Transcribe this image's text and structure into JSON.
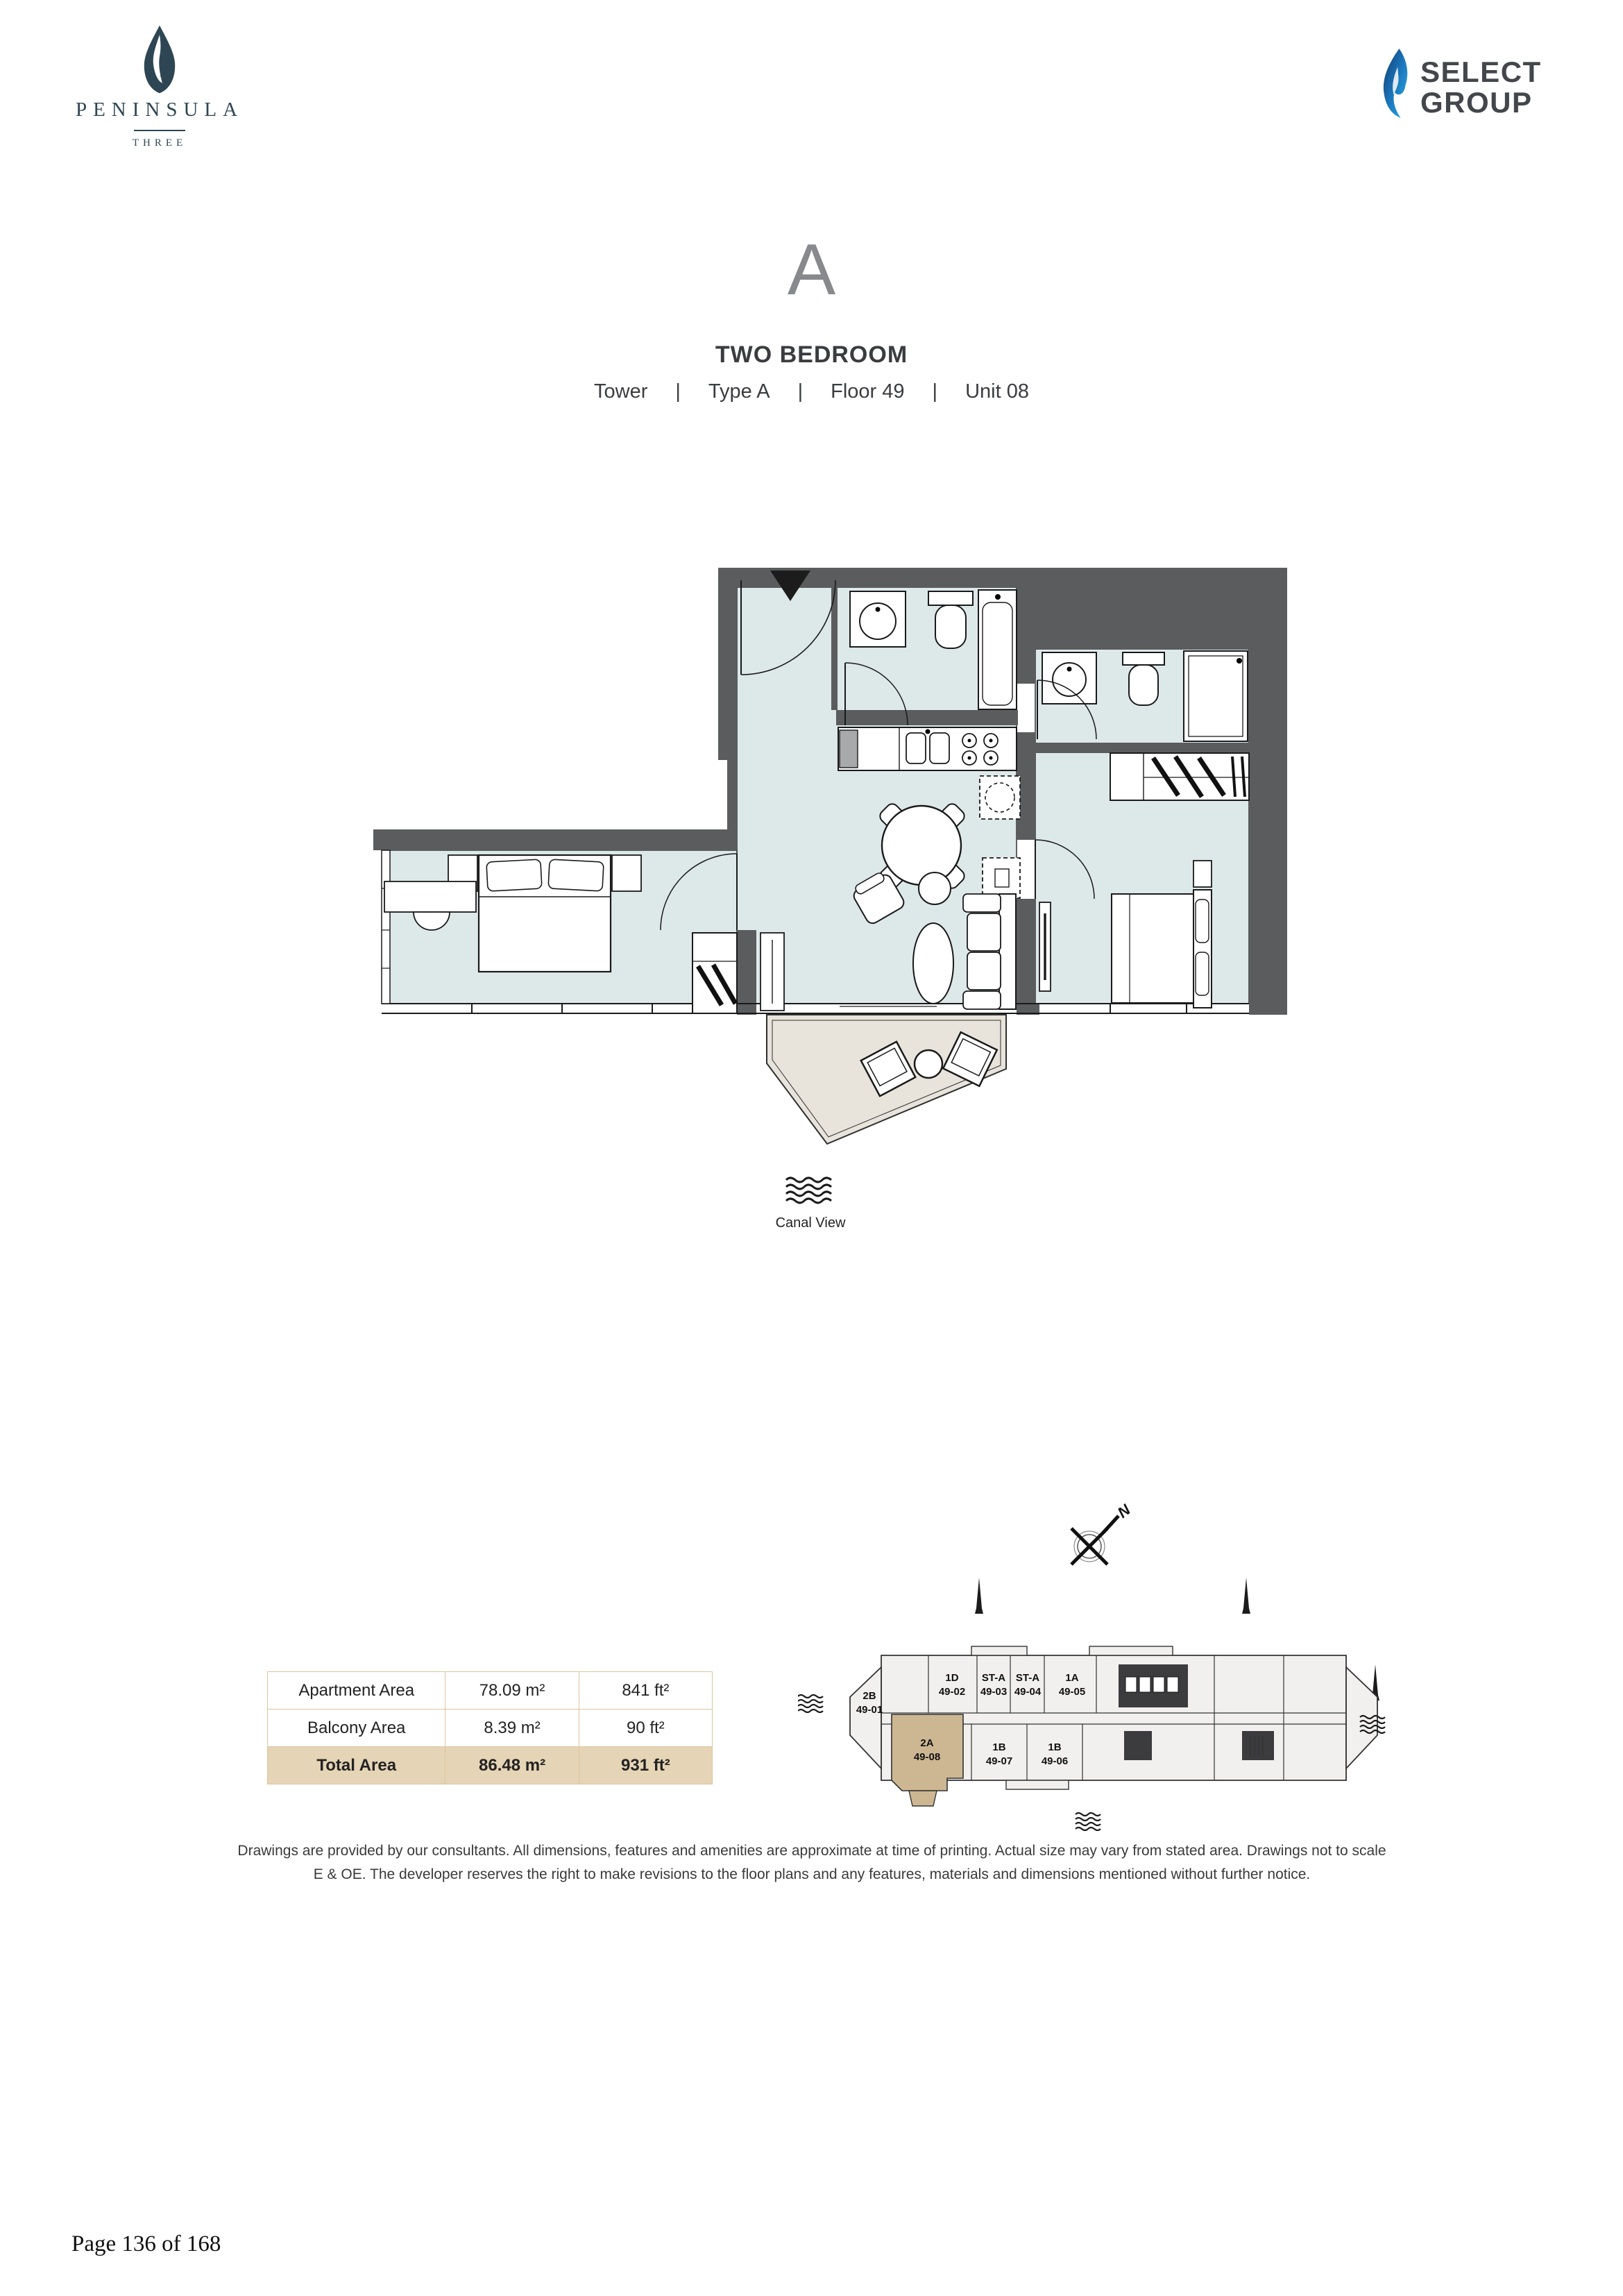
{
  "brand": {
    "name": "PENINSULA",
    "sub": "THREE"
  },
  "developer": {
    "line1": "SELECT",
    "line2": "GROUP"
  },
  "unit": {
    "type_letter": "A",
    "title": "TWO BEDROOM",
    "separator": "|",
    "meta": [
      "Tower",
      "Type A",
      "Floor 49",
      "Unit 08"
    ]
  },
  "floor_plan": {
    "view_label": "Canal View"
  },
  "area_table": {
    "rows": [
      {
        "label": "Apartment Area",
        "metric": "78.09 m²",
        "imperial": "841 ft²"
      },
      {
        "label": "Balcony Area",
        "metric": "8.39 m²",
        "imperial": "90 ft²"
      },
      {
        "label": "Total Area",
        "metric": "86.48 m²",
        "imperial": "931 ft²"
      }
    ]
  },
  "key_plan": {
    "north_label": "N",
    "highlighted_unit": "2A 49-08",
    "units": [
      {
        "code": "2B",
        "number": "49-01"
      },
      {
        "code": "1D",
        "number": "49-02"
      },
      {
        "code": "ST-A",
        "number": "49-03"
      },
      {
        "code": "ST-A",
        "number": "49-04"
      },
      {
        "code": "1A",
        "number": "49-05"
      },
      {
        "code": "2A",
        "number": "49-08"
      },
      {
        "code": "1B",
        "number": "49-07"
      },
      {
        "code": "1B",
        "number": "49-06"
      }
    ]
  },
  "disclaimer": "Drawings are provided by our consultants. All dimensions, features and amenities are approximate at time of printing.  Actual size may vary from stated area. Drawings not to scale E & OE. The developer reserves the right to make revisions to the floor plans and any features, materials and dimensions mentioned without further notice.",
  "footer": {
    "page_label": "Page 136 of 168"
  },
  "colors": {
    "wall": "#5b5c5e",
    "room": "#dde8e9",
    "balcony": "#e8e3db",
    "highlight": "#cdb793",
    "table_accent": "#e5d4b5"
  }
}
